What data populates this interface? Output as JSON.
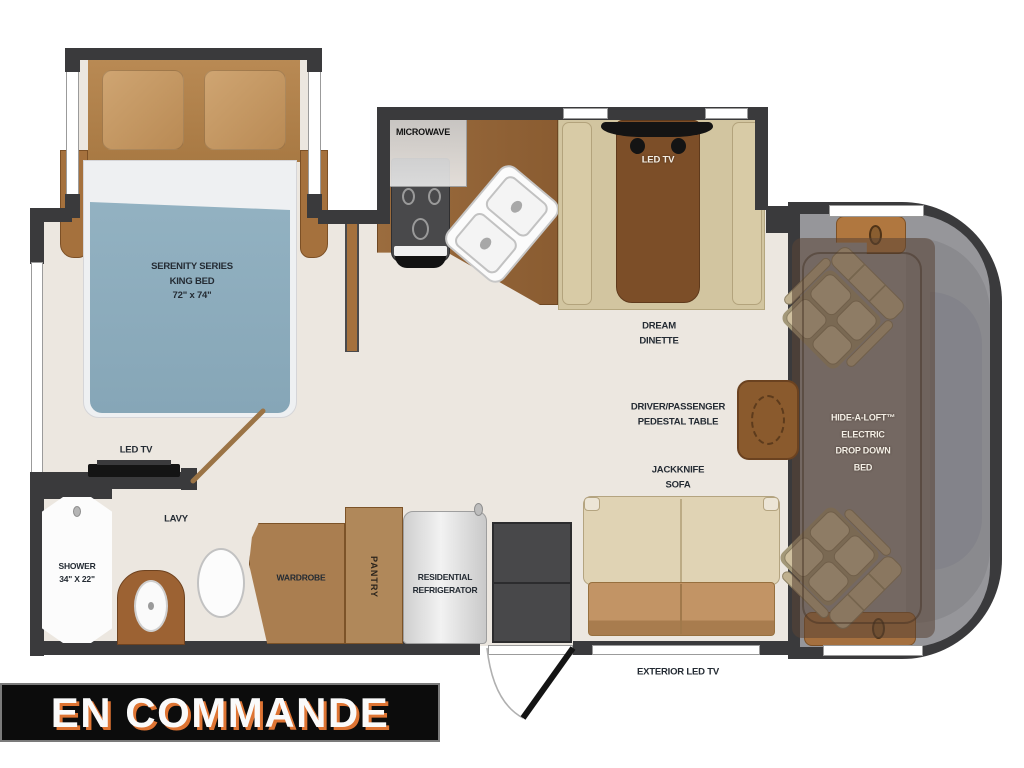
{
  "banner": {
    "text": "EN COMMANDE",
    "background": "#0c0c0c",
    "text_color": "#fafafa",
    "shadow_color": "#de7433"
  },
  "floorplan": {
    "bedroom": {
      "series_line1": "SERENITY SERIES",
      "series_line2": "KING BED",
      "series_line3": "72\" x 74\"",
      "tv": "LED TV"
    },
    "bathroom": {
      "name": "LAVY",
      "shower_line1": "SHOWER",
      "shower_line2": "34\" X 22\""
    },
    "kitchen": {
      "microwave": "MICROWAVE"
    },
    "storage": {
      "wardrobe": "WARDROBE",
      "pantry": "PANTRY",
      "refrigerator_line1": "RESIDENTIAL",
      "refrigerator_line2": "REFRIGERATOR"
    },
    "dinette": {
      "tv": "LED TV",
      "name_line1": "DREAM",
      "name_line2": "DINETTE"
    },
    "living": {
      "table_line1": "DRIVER/PASSENGER",
      "table_line2": "PEDESTAL TABLE",
      "sofa_line1": "JACKKNIFE",
      "sofa_line2": "SOFA",
      "exterior_tv": "EXTERIOR LED TV"
    },
    "cab": {
      "loft_line1": "HIDE-A-LOFT™",
      "loft_line2": "ELECTRIC",
      "loft_line3": "DROP DOWN",
      "loft_line4": "BED"
    }
  },
  "palette": {
    "wall": "#3a3a3c",
    "floor": "#ece7e0",
    "cabinet_brown": "#9c6c3e",
    "dinette_table_brown": "#7c4e28",
    "bed_blanket_blue": "#8dadbe",
    "sofa_tan": "#e0d3b4",
    "sofa_seat_brown": "#bd9160",
    "cab_gray": "#96969a",
    "seat_tan": "#cfc09f",
    "banner_shadow": "#de7433"
  }
}
